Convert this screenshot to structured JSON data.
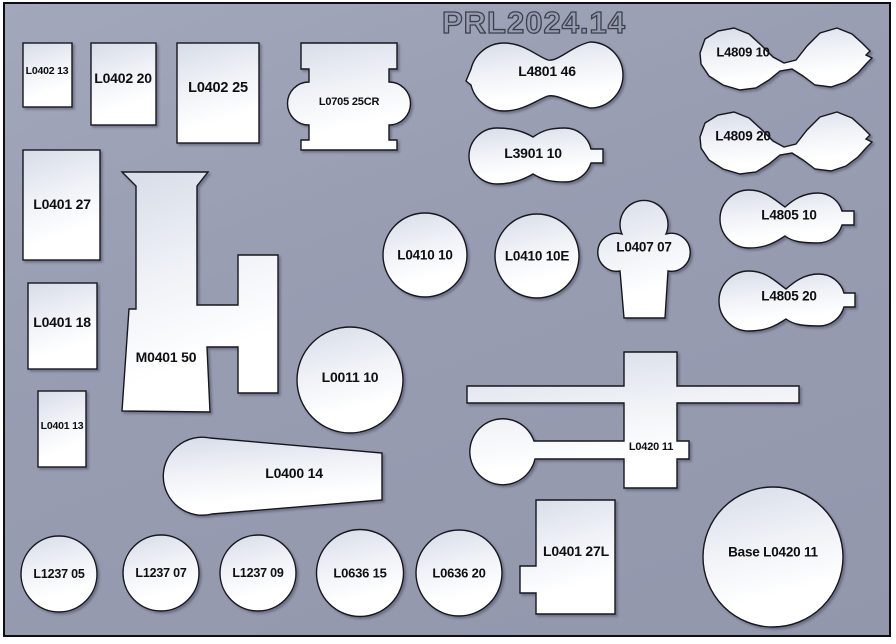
{
  "sheet": {
    "title": "PRL2024.14"
  },
  "colors": {
    "background": "#999db2",
    "border": "#0e0e12",
    "shape_fill_dark": "#d9deea",
    "shape_fill_light": "#ffffff",
    "shape_outline": "#17171d",
    "label_text": "#0e0e13",
    "title_outline": "#3d3f4a"
  },
  "parts": [
    {
      "id": "l0402-13",
      "label": "L0402 13"
    },
    {
      "id": "l0402-20",
      "label": "L0402 20"
    },
    {
      "id": "l0402-25",
      "label": "L0402 25"
    },
    {
      "id": "l0705-25cr",
      "label": "L0705 25CR"
    },
    {
      "id": "l4801-46",
      "label": "L4801 46"
    },
    {
      "id": "l3901-10",
      "label": "L3901 10"
    },
    {
      "id": "l4809-10",
      "label": "L4809 10"
    },
    {
      "id": "l4809-20",
      "label": "L4809 20"
    },
    {
      "id": "l0401-27",
      "label": "L0401 27"
    },
    {
      "id": "m0401-50",
      "label": "M0401 50"
    },
    {
      "id": "l0410-10",
      "label": "L0410 10"
    },
    {
      "id": "l0410-10e",
      "label": "L0410 10E"
    },
    {
      "id": "l0407-07",
      "label": "L0407 07"
    },
    {
      "id": "l4805-10",
      "label": "L4805 10"
    },
    {
      "id": "l4805-20",
      "label": "L4805 20"
    },
    {
      "id": "l0401-18",
      "label": "L0401 18"
    },
    {
      "id": "l0011-10",
      "label": "L0011 10"
    },
    {
      "id": "l0420-11",
      "label": "L0420 11"
    },
    {
      "id": "l0401-13",
      "label": "L0401 13"
    },
    {
      "id": "l0400-14",
      "label": "L0400 14"
    },
    {
      "id": "l1237-05",
      "label": "L1237 05"
    },
    {
      "id": "l1237-07",
      "label": "L1237 07"
    },
    {
      "id": "l1237-09",
      "label": "L1237 09"
    },
    {
      "id": "l0636-15",
      "label": "L0636 15"
    },
    {
      "id": "l0636-20",
      "label": "L0636 20"
    },
    {
      "id": "l0401-27l",
      "label": "L0401 27L"
    },
    {
      "id": "base-l0420-11",
      "label": "Base L0420 11"
    }
  ]
}
